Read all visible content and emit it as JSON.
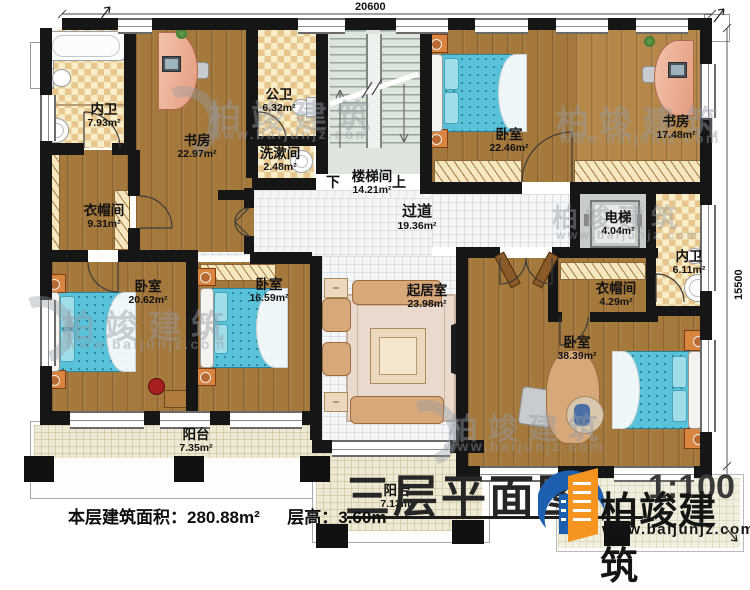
{
  "meta": {
    "title": "三层平面图",
    "scale": "1:100"
  },
  "dimensions": {
    "top": "20600",
    "right": "15500"
  },
  "stairs": {
    "down": "下",
    "up": "上"
  },
  "rooms": [
    {
      "name": "内卫",
      "area": "7.93m²"
    },
    {
      "name": "书房",
      "area": "22.97m²"
    },
    {
      "name": "公卫",
      "area": "6.32m²"
    },
    {
      "name": "洗漱间",
      "area": "2.48m²"
    },
    {
      "name": "楼梯间",
      "area": "14.21m²"
    },
    {
      "name": "衣帽间",
      "area": "9.31m²"
    },
    {
      "name": "卧室",
      "area": "22.46m²"
    },
    {
      "name": "书房",
      "area": "17.48m²"
    },
    {
      "name": "过道",
      "area": "19.36m²"
    },
    {
      "name": "电梯",
      "area": "4.04m²"
    },
    {
      "name": "内卫",
      "area": "6.11m²"
    },
    {
      "name": "衣帽间",
      "area": "4.29m²"
    },
    {
      "name": "卧室",
      "area": "20.62m²"
    },
    {
      "name": "卧室",
      "area": "16.59m²"
    },
    {
      "name": "起居室",
      "area": "23.98m²"
    },
    {
      "name": "卧室",
      "area": "38.39m²"
    },
    {
      "name": "阳台",
      "area": "7.35m²"
    },
    {
      "name": "阳台",
      "area": "7.13m²"
    }
  ],
  "footer": {
    "area_label": "本层建筑面积：",
    "area_value": "280.88m²",
    "height_label": "层高：",
    "height_value": "3.60m"
  },
  "brand": {
    "name": "柏竣建筑",
    "url": "www.baijunjz.com"
  },
  "watermark": {
    "name": "柏竣建筑",
    "url": "www.baijunjz.com"
  }
}
